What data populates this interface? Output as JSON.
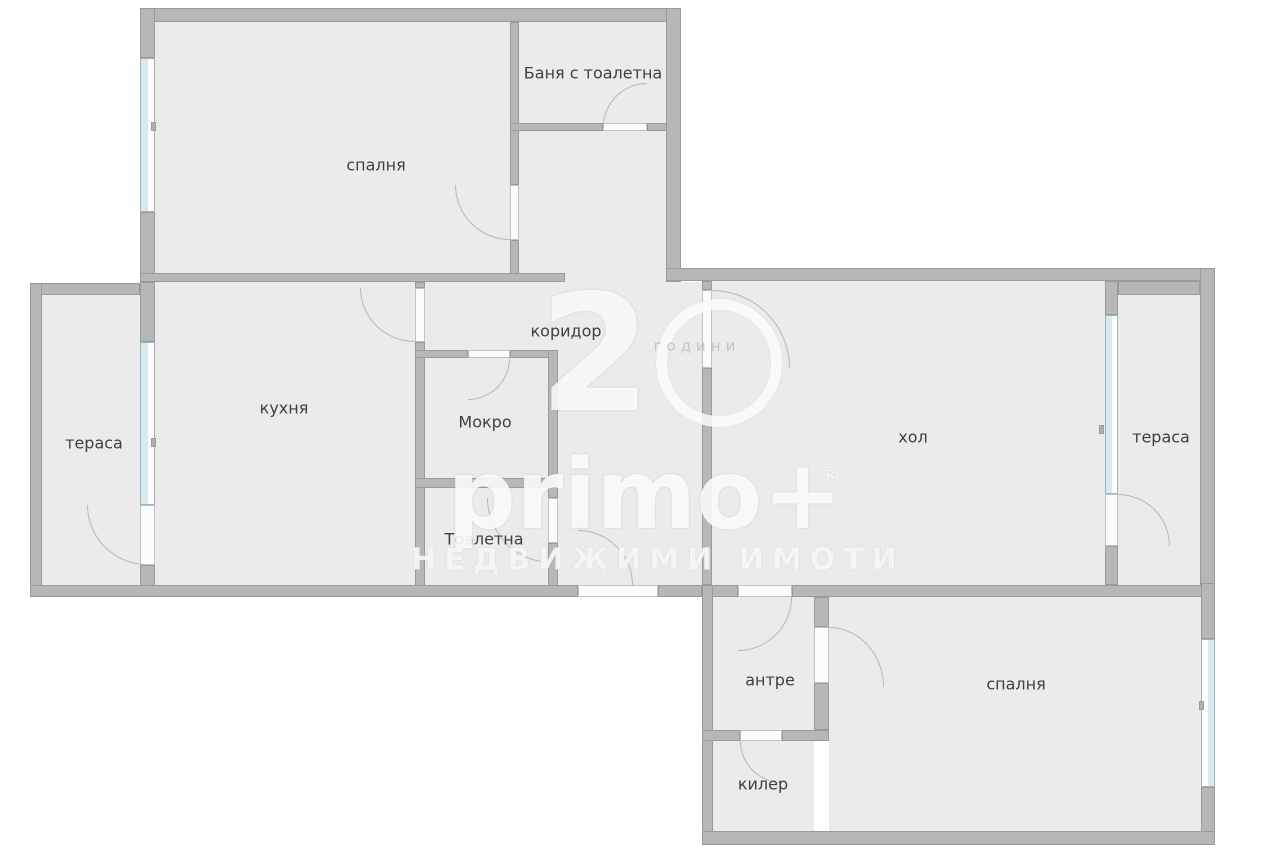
{
  "plan": {
    "rooms": {
      "bedroom_top": {
        "label": "спалня"
      },
      "bathroom": {
        "label": "Баня с тоалетна"
      },
      "corridor": {
        "label": "коридор"
      },
      "kitchen": {
        "label": "кухня"
      },
      "terrace_left": {
        "label": "тераса"
      },
      "utility_room": {
        "label": "Мокро"
      },
      "toilet": {
        "label": "Тоалетна"
      },
      "living_room": {
        "label": "хол"
      },
      "terrace_right": {
        "label": "тераса"
      },
      "entry_hall": {
        "label": "антре"
      },
      "closet": {
        "label": "килер"
      },
      "bedroom_bottom": {
        "label": "спалня"
      }
    },
    "watermark": {
      "big_digit": "2",
      "circle_digit": "0",
      "word": "години",
      "brand": "primo+",
      "registered_mark": "®",
      "tagline": "НЕДВИЖИМИ ИМОТИ"
    },
    "colors": {
      "background": "#ffffff",
      "floor": "#ebebeb",
      "wall": "#b7b7b7",
      "wall_edge": "#9a9a9a",
      "window_glass": "#d8e9f1",
      "door": "#fcfcfc",
      "door_arc": "#b8b8b8",
      "label_text": "#3f3f3f"
    }
  }
}
